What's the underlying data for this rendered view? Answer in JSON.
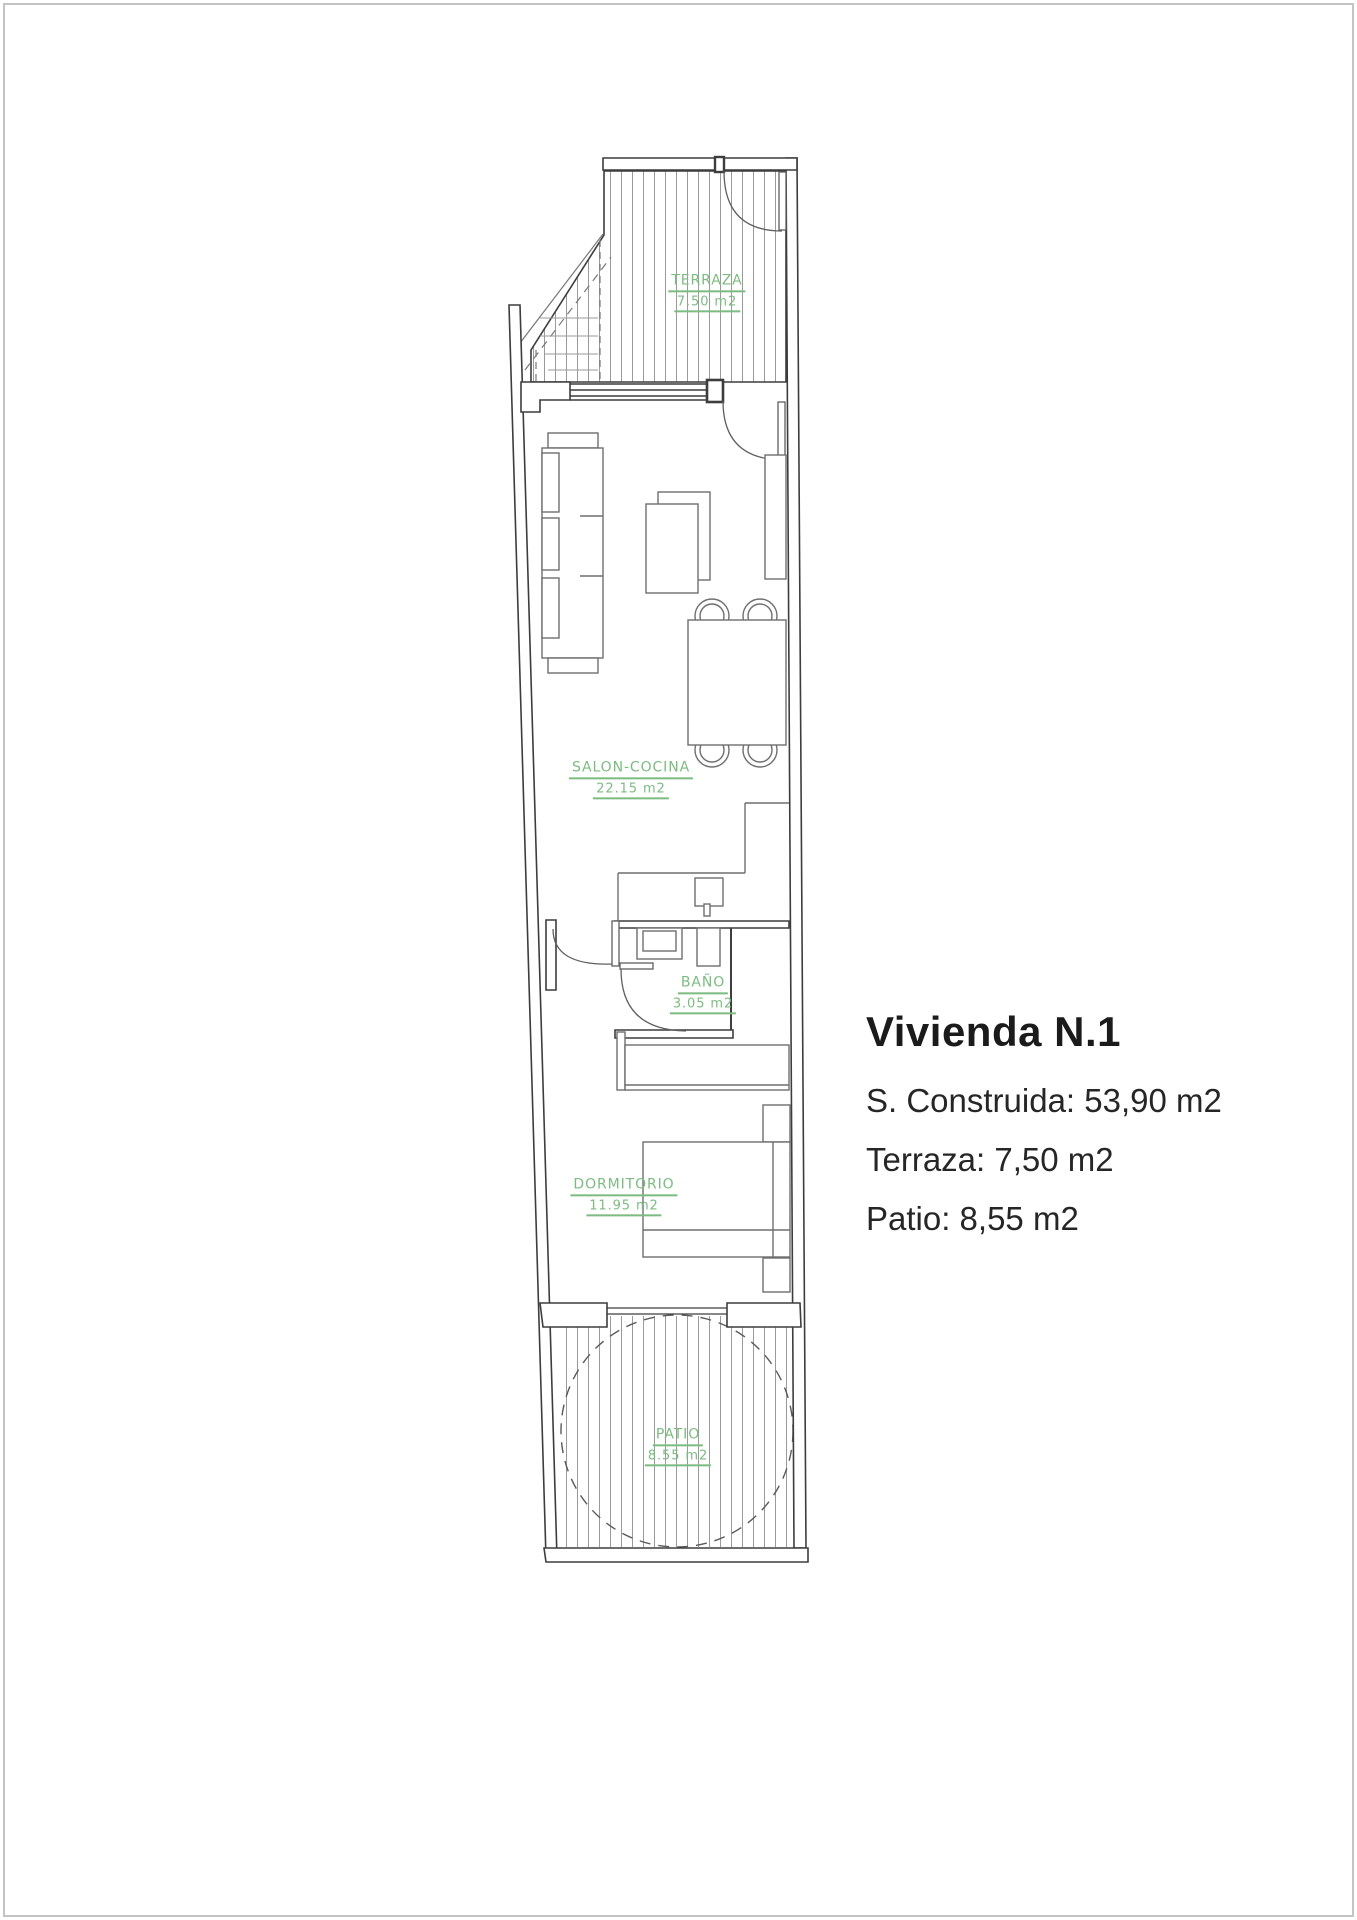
{
  "page": {
    "background": "#ffffff",
    "frame_color": "#c4c4c4"
  },
  "plan": {
    "accent_green": "#7cbc81",
    "wall_color": "#3d3d3d",
    "furniture_color": "#6e6e6e",
    "hatch_color": "#9a9a9a",
    "rooms": [
      {
        "id": "terraza",
        "name": "TERRAZA",
        "area": "7.50 m2"
      },
      {
        "id": "salon",
        "name": "SALON-COCINA",
        "area": "22.15 m2"
      },
      {
        "id": "bano",
        "name": "BAÑO",
        "area": "3.05 m2"
      },
      {
        "id": "dormitorio",
        "name": "DORMITORIO",
        "area": "11.95 m2"
      },
      {
        "id": "patio",
        "name": "PATIO",
        "area": "8.55 m2"
      }
    ]
  },
  "info": {
    "title": "Vivienda N.1",
    "lines": [
      "S. Construida: 53,90 m2",
      "Terraza: 7,50 m2",
      "Patio: 8,55 m2"
    ]
  }
}
